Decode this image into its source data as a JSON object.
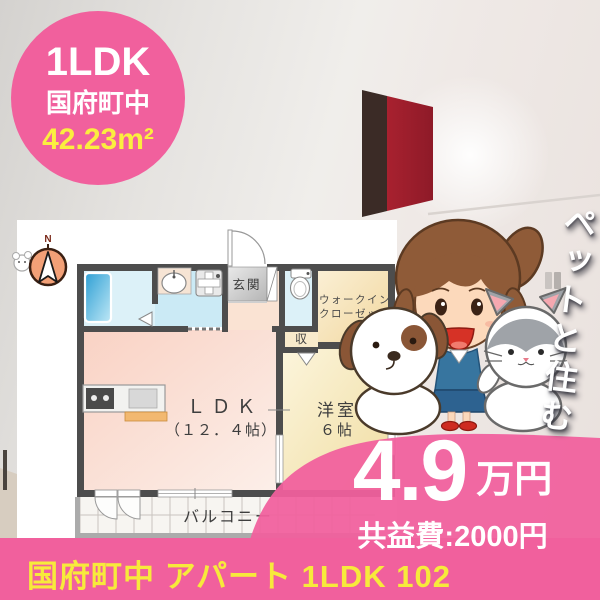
{
  "badge": {
    "type": "1LDK",
    "location": "国府町中",
    "area": "42.23m²"
  },
  "floorplan": {
    "compass": "N",
    "labels": {
      "genkan": "玄関",
      "wic1": "ウォークイン",
      "wic2": "クローゼット",
      "storage": "収",
      "ldk": "ＬＤＫ",
      "ldk_size": "（１２．４帖）",
      "western_room": "洋室",
      "western_size": "６帖",
      "balcony": "バルコニー"
    }
  },
  "promo": {
    "vertical_text": "ペットと住む"
  },
  "price": {
    "amount": "4.9",
    "unit": "万円",
    "fee_label": "共益費:2000円"
  },
  "footer": {
    "caption": "国府町中 アパート 1LDK 102"
  },
  "colors": {
    "accent_pink": "#F1609D",
    "highlight_yellow": "#F7EA3B",
    "wall_dark": "#4D4D4D"
  }
}
